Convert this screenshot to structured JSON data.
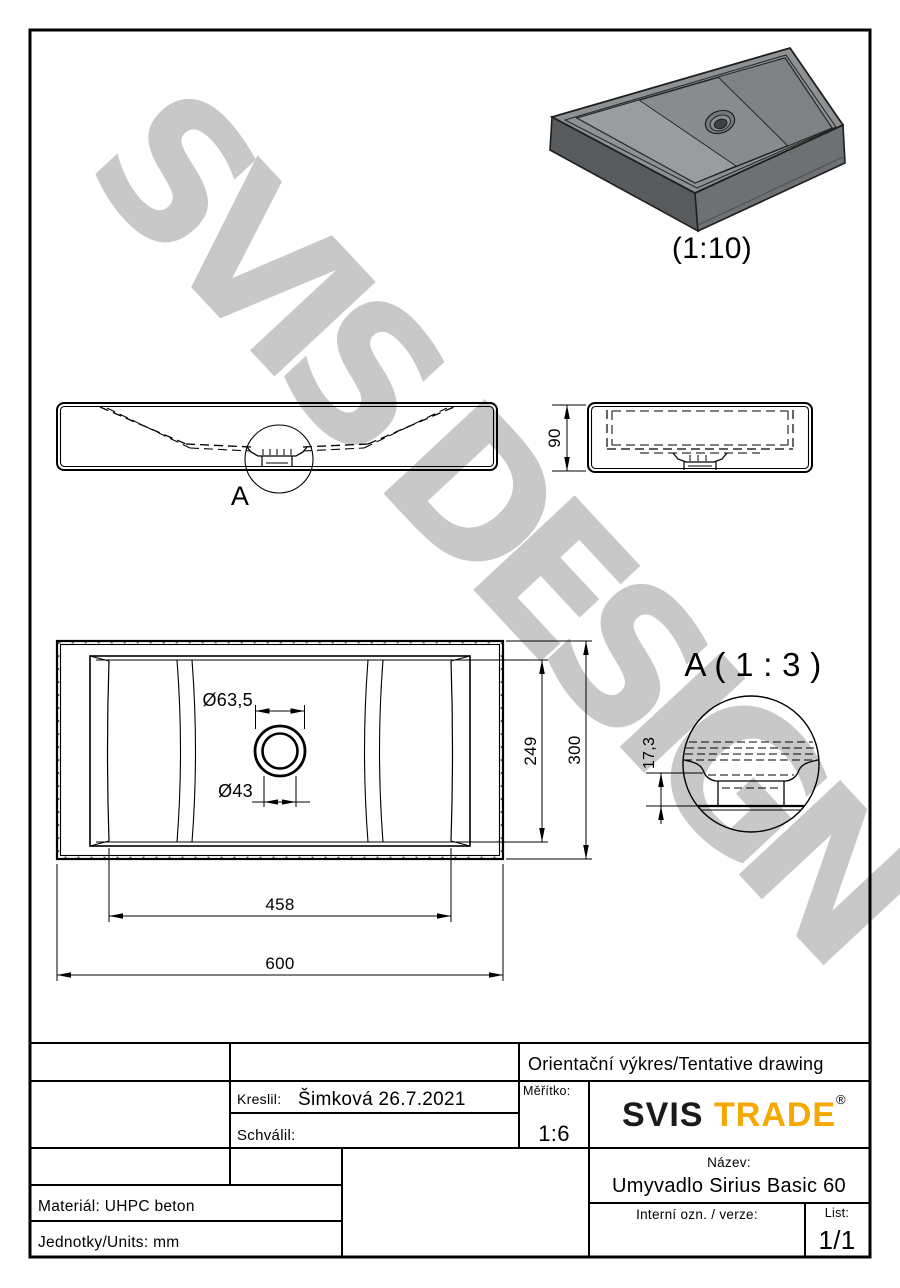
{
  "drawing": {
    "watermark": "SVIS DESIGN",
    "iso_view": {
      "scale_label": "(1:10)"
    },
    "front_view": {
      "detail_marker": "A"
    },
    "side_view": {
      "dim_height": "90"
    },
    "plan_view": {
      "dim_drain_outer": "Ø63,5",
      "dim_drain_inner": "Ø43",
      "dim_inner_width": "249",
      "dim_outer_width": "300",
      "dim_inner_length": "458",
      "dim_outer_length": "600"
    },
    "detail_view": {
      "title": "A ( 1 : 3 )",
      "dim_depth": "17,3"
    }
  },
  "title_block": {
    "tentative": "Orientační výkres/Tentative drawing",
    "kreslil_label": "Kreslil:",
    "kreslil_value": "Šimková 26.7.2021",
    "schvalil_label": "Schválil:",
    "meritko_label": "Měřítko:",
    "meritko_value": "1:6",
    "logo": {
      "part1": "SVIS",
      "part2": "TRADE",
      "reg": "®"
    },
    "nazev_label": "Název:",
    "nazev_value": "Umyvadlo Sirius Basic 60",
    "interni_label": "Interní ozn. / verze:",
    "list_label": "List:",
    "list_value": "1/1",
    "material": "Materiál: UHPC beton",
    "units": "Jednotky/Units: mm"
  },
  "colors": {
    "accent": "#F5A800",
    "line": "#000000",
    "watermark_gray": "#C6C6C6",
    "iso_top": "#8E9193",
    "iso_front": "#6E7174",
    "iso_end": "#585B5D"
  }
}
